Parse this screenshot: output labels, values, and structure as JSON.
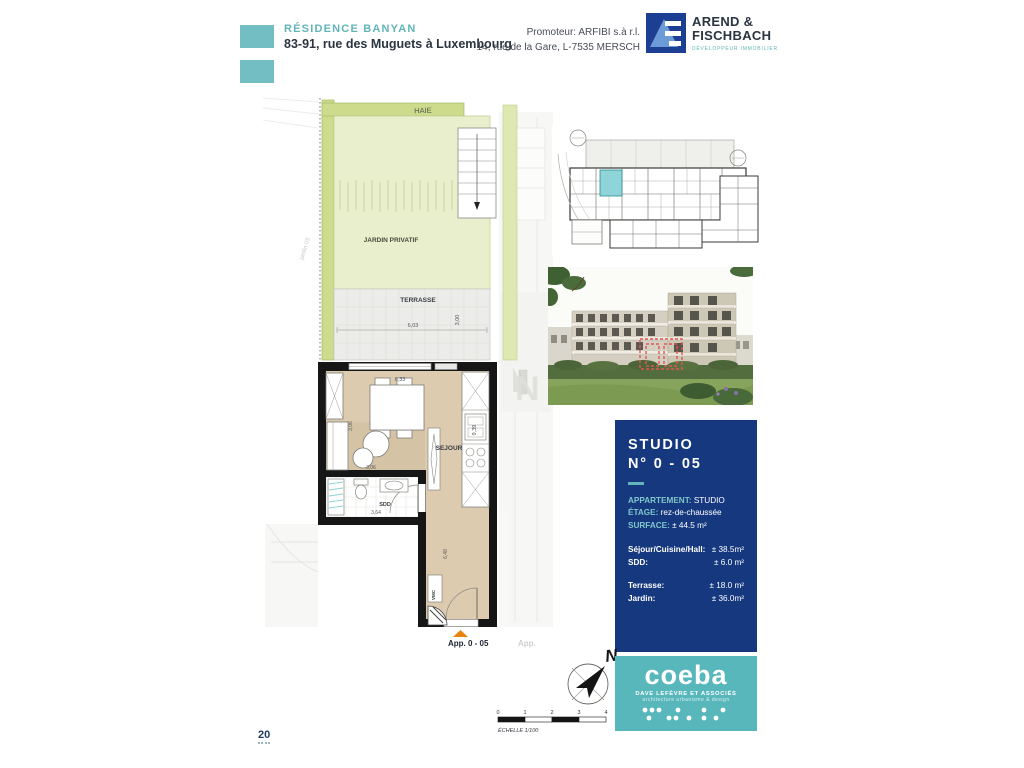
{
  "header": {
    "project_name": "RÉSIDENCE BANYAN",
    "project_address": "83-91, rue des Muguets à Luxembourg",
    "promoter_line1": "Promoteur: ARFIBI s.à r.l.",
    "promoter_line2": "14, rue de la Gare, L-7535 MERSCH",
    "logo": {
      "name_line1": "AREND &",
      "name_line2": "FISCHBACH",
      "tagline": "DÉVELOPPEUR IMMOBILIER"
    }
  },
  "plan": {
    "labels": {
      "haie": "HAIE",
      "jardin": "JARDIN PRIVATIF",
      "terrasse": "TERRASSE",
      "sejour": "SEJOUR",
      "sdd": "SDD",
      "vmc": "VMC",
      "apartment": "App. 0 - 05",
      "neighbor": "App.",
      "side_note": "jardin 05"
    },
    "dims": {
      "terrasse_w": "6,03",
      "terrasse_h": "3,00",
      "sejour_w": "6,33",
      "sejour_h": "9,39",
      "sejour_d": "3,06",
      "sdd_w": "3,64",
      "hall_h": "6,48"
    }
  },
  "info_panel": {
    "title_line1": "STUDIO",
    "title_line2": "N° 0 - 05",
    "rows": [
      {
        "label": "APPARTEMENT:",
        "value": "STUDIO"
      },
      {
        "label": "ÉTAGE:",
        "value": "rez-de-chaussée"
      },
      {
        "label": "SURFACE:",
        "value": "± 44.5 m²"
      }
    ],
    "rows2": [
      {
        "label": "Séjour/Cuisine/Hall:",
        "value": "± 38.5m²"
      },
      {
        "label": "SDD:",
        "value": "± 6.0 m²"
      }
    ],
    "rows3": [
      {
        "label": "Terrasse:",
        "value": "± 18.0 m²"
      },
      {
        "label": "Jardin:",
        "value": "± 36.0m²"
      }
    ]
  },
  "compass": {
    "north": "N"
  },
  "scale": {
    "ticks": [
      "0",
      "1",
      "2",
      "3",
      "4"
    ],
    "label": "ÉCHELLE  1/100"
  },
  "coeba": {
    "name": "coeba",
    "line1": "DAVE LEFÈVRE ET ASSOCIÉS",
    "line2": "architecture  urbanisme  &  design"
  },
  "page_number": "20",
  "colors": {
    "accent_teal": "#62b5b9",
    "panel_blue": "#16387e",
    "coeba_teal": "#58b7bb",
    "hedge_green": "#cddc8e",
    "garden_green": "#e9efcd",
    "floor_beige": "#ddcbb0",
    "highlight_teal": "#8fd4d8",
    "marker_orange": "#e8820c",
    "marker_red": "#e25555"
  }
}
